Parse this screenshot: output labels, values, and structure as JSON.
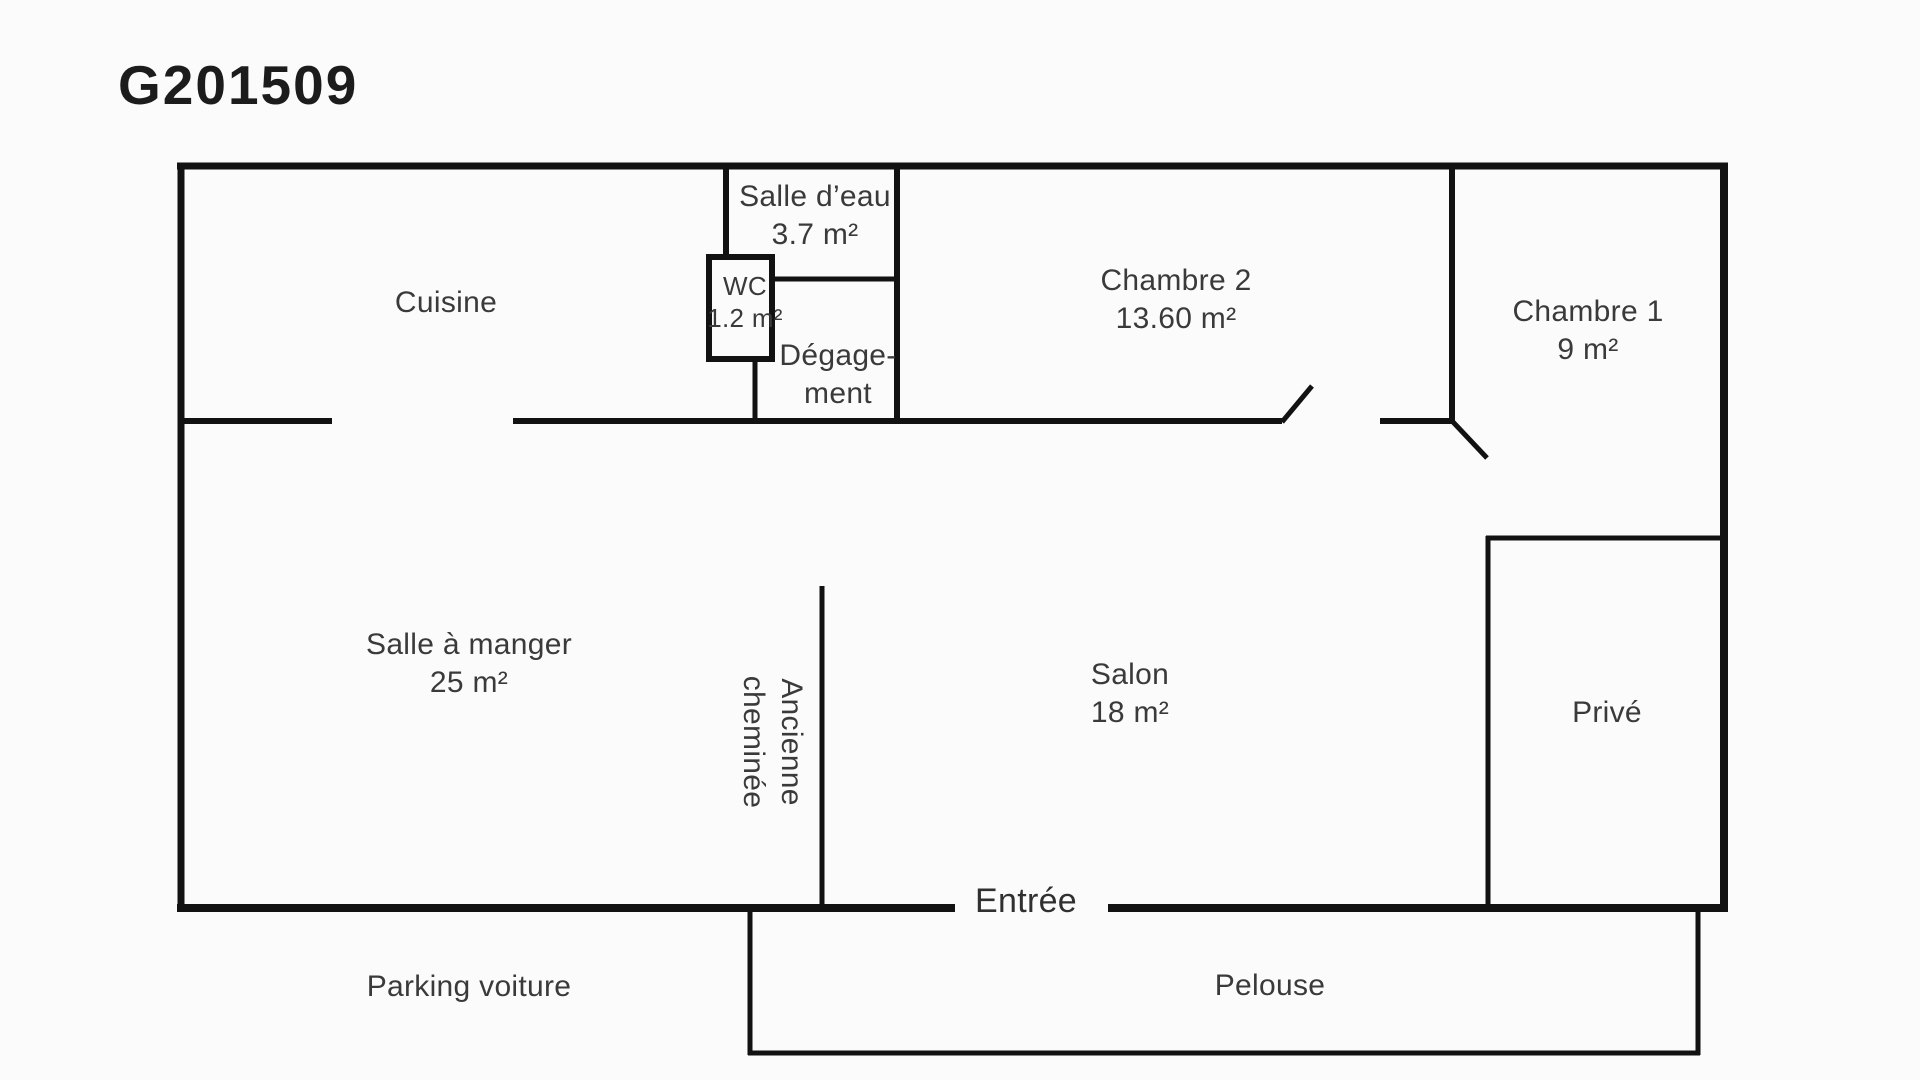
{
  "title": "G201509",
  "colors": {
    "background": "#fbfbfb",
    "wall": "#121212",
    "label": "#3a3a3a",
    "title": "#1c1c1c"
  },
  "rooms": {
    "cuisine": {
      "name": "Cuisine"
    },
    "salle_deau": {
      "name": "Salle d’eau",
      "area": "3.7 m²"
    },
    "wc": {
      "name": "WC",
      "area": "1.2 m²"
    },
    "degagement": {
      "line1": "Dégage-",
      "line2": "ment"
    },
    "chambre2": {
      "name": "Chambre 2",
      "area": "13.60 m²"
    },
    "chambre1": {
      "name": "Chambre 1",
      "area": "9 m²"
    },
    "salle_a_manger": {
      "name": "Salle à manger",
      "area": "25 m²"
    },
    "ancienne_cheminee": {
      "line1": "Ancienne",
      "line2": "cheminée"
    },
    "salon": {
      "name": "Salon",
      "area": "18 m²"
    },
    "prive": {
      "name": "Privé"
    },
    "entree": {
      "name": "Entrée"
    }
  },
  "exterior": {
    "parking": {
      "name": "Parking voiture"
    },
    "pelouse": {
      "name": "Pelouse"
    }
  }
}
